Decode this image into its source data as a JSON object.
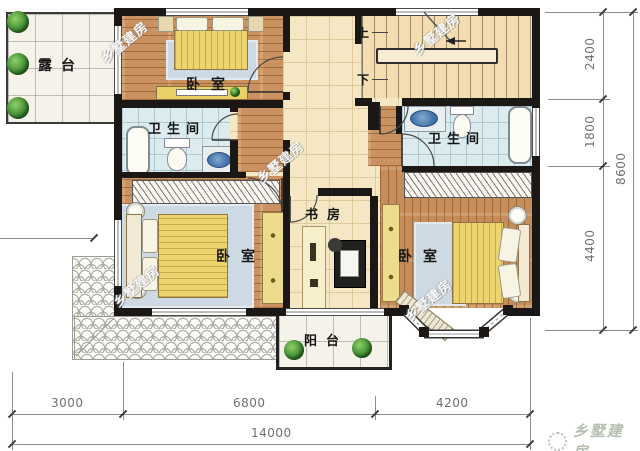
{
  "plan": {
    "rooms": {
      "terrace": "露台",
      "bedroom_top": "卧室",
      "bathroom_left": "卫生间",
      "bathroom_right": "卫生间",
      "study": "书房",
      "bedroom_left": "卧室",
      "bedroom_right": "卧室",
      "balcony": "阳台"
    },
    "stairs": {
      "up": "上",
      "down": "下"
    }
  },
  "dimensions": {
    "right_segments": [
      "2400",
      "1800",
      "4400"
    ],
    "right_total": "8600",
    "bottom_segments": [
      "3000",
      "6800",
      "4200"
    ],
    "bottom_total": "14000"
  },
  "watermark_text": "乡墅建房",
  "brand_text": "乡墅建房",
  "colors": {
    "wall": "#1a1714",
    "wood_floor": "#ca9260",
    "hall_tile": "#f6e7c4",
    "bath_tile": "#dbebee",
    "bed_blanket": "#edd46e",
    "plant_green": "#4f9a3c",
    "dimension_text": "#6f6f6f",
    "brand_gray_green": "#b6bfb0"
  }
}
